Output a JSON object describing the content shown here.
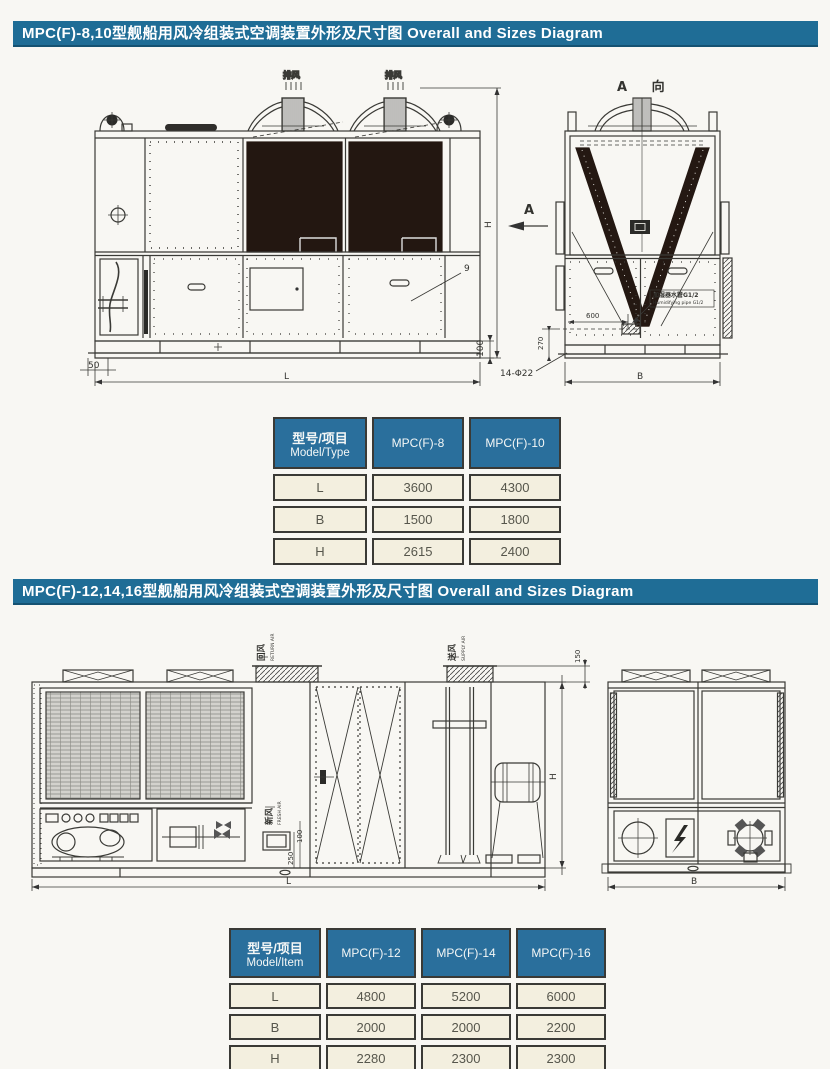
{
  "section1": {
    "title": "MPC(F)-8,10型舰船用风冷组装式空调装置外形及尺寸图 Overall and Sizes Diagram",
    "front_view": {
      "exhaust1": "排风",
      "exhaust2": "排风",
      "view_arrow": "A",
      "callout_9": "9",
      "dim_50": "50",
      "dim_L": "L",
      "dim_100": "100",
      "dim_H": "H"
    },
    "side_view": {
      "view_title": "A 向",
      "dim_600": "600",
      "dim_270": "270",
      "dim_holes": "14-Φ22",
      "dim_B": "B",
      "pipe_callout_cn": "加湿器水管G1/2",
      "pipe_callout_en": "Humidifying pipe G1/2"
    },
    "table": {
      "corner_cn": "型号/项目",
      "corner_en": "Model/Type",
      "col1": "MPC(F)-8",
      "col2": "MPC(F)-10",
      "rows": [
        [
          "L",
          "3600",
          "4300"
        ],
        [
          "B",
          "1500",
          "1800"
        ],
        [
          "H",
          "2615",
          "2400"
        ]
      ]
    }
  },
  "section2": {
    "title": "MPC(F)-12,14,16型舰船用风冷组装式空调装置外形及尺寸图 Overall and Sizes Diagram",
    "side_view": {
      "return_cn": "回风",
      "return_en": "RETURN AIR",
      "supply_cn": "送风",
      "supply_en": "SUPPLY AIR",
      "fresh_cn": "新风",
      "fresh_en": "FRESH AIR",
      "dim_150": "150",
      "dim_250": "250",
      "dim_100": "100",
      "dim_L": "L",
      "dim_H": "H"
    },
    "end_view": {
      "dim_B": "B"
    },
    "table": {
      "corner_cn": "型号/项目",
      "corner_en": "Model/Item",
      "col1": "MPC(F)-12",
      "col2": "MPC(F)-14",
      "col3": "MPC(F)-16",
      "rows": [
        [
          "L",
          "4800",
          "5200",
          "6000"
        ],
        [
          "B",
          "2000",
          "2000",
          "2200"
        ],
        [
          "H",
          "2280",
          "2300",
          "2300"
        ]
      ]
    }
  }
}
